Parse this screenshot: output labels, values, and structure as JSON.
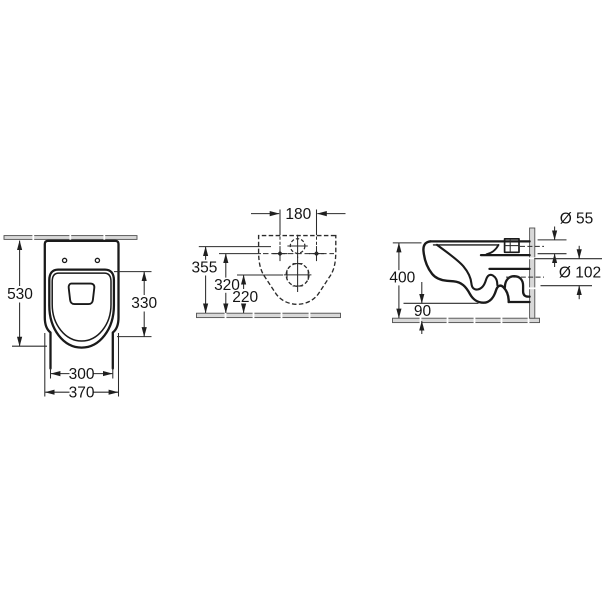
{
  "drawing": {
    "views": {
      "front": {
        "dims": {
          "overall_height": "530",
          "bowl_span": "330",
          "lower_width": "300",
          "overall_width": "370"
        }
      },
      "rear": {
        "dims": {
          "fixing_hole_spacing": "180",
          "inlet_center_height": "355",
          "fixing_hole_height": "320",
          "outlet_center_height": "220"
        }
      },
      "side": {
        "dims": {
          "overall_height": "400",
          "floor_clearance": "90",
          "inlet_diameter": "Ø 55",
          "outlet_diameter": "Ø 102"
        }
      }
    },
    "colors": {
      "background": "#ffffff",
      "outline": "#1a1a1a",
      "dimension_lines": "#2b2b2b",
      "wall_floor_hatch": "#d8d8d8"
    }
  }
}
